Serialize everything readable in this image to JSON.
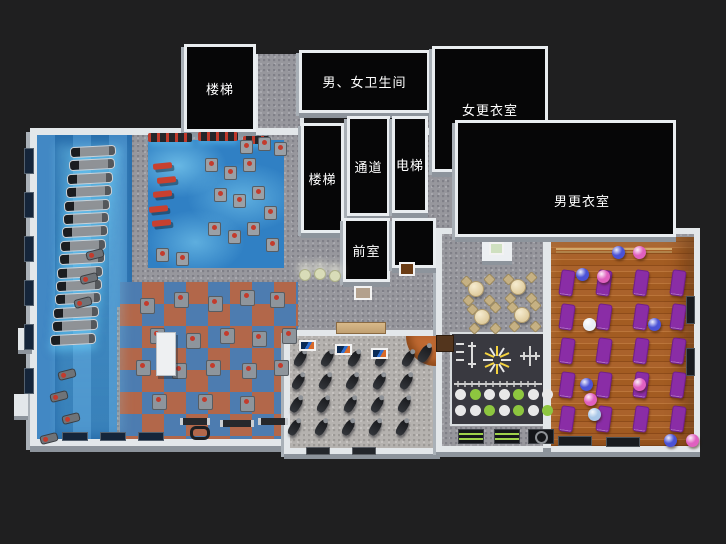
{
  "scene": {
    "description": "3D isometric floor plan render of a gym / fitness club",
    "background": "#1f1f20"
  },
  "palette": {
    "wall": "#e3e7ea",
    "roof_black": "#060607",
    "floor_blue": "#2d7bbd",
    "glow_cyan": "#8ce0ff",
    "carpet_gray": "#97979d",
    "tile_red": "#b2674a",
    "tile_blue": "#4d7cb0",
    "wood_orange": "#a35c22",
    "mat_purple": "#8a2da6",
    "accent_green": "#8dc63f",
    "bench_red": "#c8402f"
  },
  "rooms": {
    "stairs_nw": {
      "label": "楼梯"
    },
    "restrooms": {
      "label": "男、女卫生间"
    },
    "women_locker": {
      "label": "女更衣室"
    },
    "men_locker": {
      "label": "男更衣室"
    },
    "stairs_mid": {
      "label": "楼梯"
    },
    "corridor": {
      "label": "通道"
    },
    "elevator": {
      "label": "电梯"
    },
    "anteroom": {
      "label": "前室"
    }
  },
  "decor": {
    "treadmills": {
      "count": 15,
      "x": 70,
      "y": 146,
      "dx": -1.4,
      "dy": 13.4,
      "w": 46,
      "h": 11
    },
    "cardio_machines": [
      [
        86,
        250
      ],
      [
        80,
        274
      ],
      [
        74,
        298
      ],
      [
        58,
        370
      ],
      [
        50,
        392
      ],
      [
        62,
        414
      ],
      [
        40,
        434
      ]
    ],
    "racks_top": [
      [
        148,
        133,
        44,
        9
      ],
      [
        198,
        132,
        40,
        9
      ],
      [
        243,
        136,
        26,
        8
      ]
    ],
    "benches_red": [
      [
        153,
        163
      ],
      [
        157,
        177
      ],
      [
        153,
        191
      ],
      [
        149,
        206
      ],
      [
        152,
        220
      ]
    ],
    "machines_blue": [
      [
        205,
        158
      ],
      [
        224,
        166
      ],
      [
        243,
        158
      ],
      [
        214,
        188
      ],
      [
        233,
        194
      ],
      [
        252,
        186
      ],
      [
        208,
        222
      ],
      [
        228,
        230
      ],
      [
        247,
        222
      ],
      [
        264,
        206
      ],
      [
        266,
        238
      ],
      [
        156,
        248
      ],
      [
        176,
        252
      ],
      [
        240,
        140
      ],
      [
        258,
        137
      ],
      [
        274,
        142
      ]
    ],
    "machines_checker": [
      [
        140,
        298
      ],
      [
        174,
        292
      ],
      [
        208,
        296
      ],
      [
        240,
        290
      ],
      [
        270,
        292
      ],
      [
        150,
        328
      ],
      [
        186,
        333
      ],
      [
        220,
        328
      ],
      [
        252,
        331
      ],
      [
        282,
        328
      ],
      [
        136,
        360
      ],
      [
        172,
        363
      ],
      [
        206,
        360
      ],
      [
        242,
        363
      ],
      [
        274,
        360
      ],
      [
        198,
        394
      ],
      [
        240,
        396
      ],
      [
        152,
        394
      ]
    ],
    "white_tower": [
      156,
      332,
      20,
      44
    ],
    "barbell_racks": [
      [
        180,
        418,
        30
      ],
      [
        220,
        420,
        34
      ],
      [
        258,
        418,
        30
      ]
    ],
    "hexbar": [
      190,
      426
    ],
    "spin_bikes": {
      "cols": 5,
      "rows": 4,
      "x": 296,
      "y": 350,
      "dx": 27,
      "dy": 23,
      "rowdx": -2
    },
    "instructor_bike": [
      420,
      344
    ],
    "yoga_mats": {
      "cols": 4,
      "rows": 5,
      "x": 560,
      "y": 270,
      "dx": 37,
      "dy": 34
    },
    "balls": [
      [
        612,
        246,
        "#4a52d6"
      ],
      [
        633,
        246,
        "#e060c0"
      ],
      [
        576,
        268,
        "#4a52d6"
      ],
      [
        597,
        270,
        "#e060c0"
      ],
      [
        583,
        318,
        "#e9eef3"
      ],
      [
        648,
        318,
        "#4a52d6"
      ],
      [
        633,
        378,
        "#e060c0"
      ],
      [
        580,
        378,
        "#4a52d6"
      ],
      [
        584,
        393,
        "#e060c0"
      ],
      [
        588,
        408,
        "#a9c7e8"
      ],
      [
        664,
        434,
        "#4a52d6"
      ],
      [
        686,
        434,
        "#e060c0"
      ]
    ],
    "cafe_tables": [
      [
        476,
        289
      ],
      [
        518,
        287
      ],
      [
        482,
        317
      ],
      [
        522,
        315
      ]
    ],
    "lounge_chairs": [
      [
        299,
        269
      ],
      [
        314,
        268
      ],
      [
        329,
        270
      ]
    ],
    "posters_spin": [
      [
        299,
        340
      ],
      [
        335,
        344
      ],
      [
        371,
        348
      ]
    ],
    "pictures": [
      [
        354,
        286,
        18,
        14,
        "#b3a08c"
      ],
      [
        399,
        262,
        16,
        14,
        "#6b3c14"
      ],
      [
        489,
        242,
        15,
        13,
        "#cfe0c0"
      ]
    ],
    "desk": [
      336,
      322,
      50,
      12
    ],
    "brown_board": [
      436,
      335,
      18,
      17
    ],
    "func_circles": {
      "x": 455,
      "dx": 14.5,
      "rows": [
        {
          "y": 389,
          "c": [
            "w",
            "g",
            "w",
            "w",
            "g",
            "w",
            "w"
          ]
        },
        {
          "y": 405,
          "c": [
            "w",
            "w",
            "g",
            "w",
            "g",
            "w",
            "g"
          ]
        }
      ]
    },
    "func_windows": [
      [
        458,
        "rails"
      ],
      [
        494,
        "rails"
      ],
      [
        528,
        "circle"
      ]
    ],
    "windows_left": [
      148,
      192,
      236,
      280,
      324,
      368
    ],
    "windows_bottom": [
      62,
      100,
      138
    ],
    "windows_spin": [
      306,
      352
    ],
    "windows_yoga": [
      [
        558,
        436,
        34,
        10
      ],
      [
        606,
        437,
        34,
        10
      ],
      [
        686,
        296,
        9,
        28
      ],
      [
        686,
        348,
        9,
        28
      ]
    ]
  }
}
